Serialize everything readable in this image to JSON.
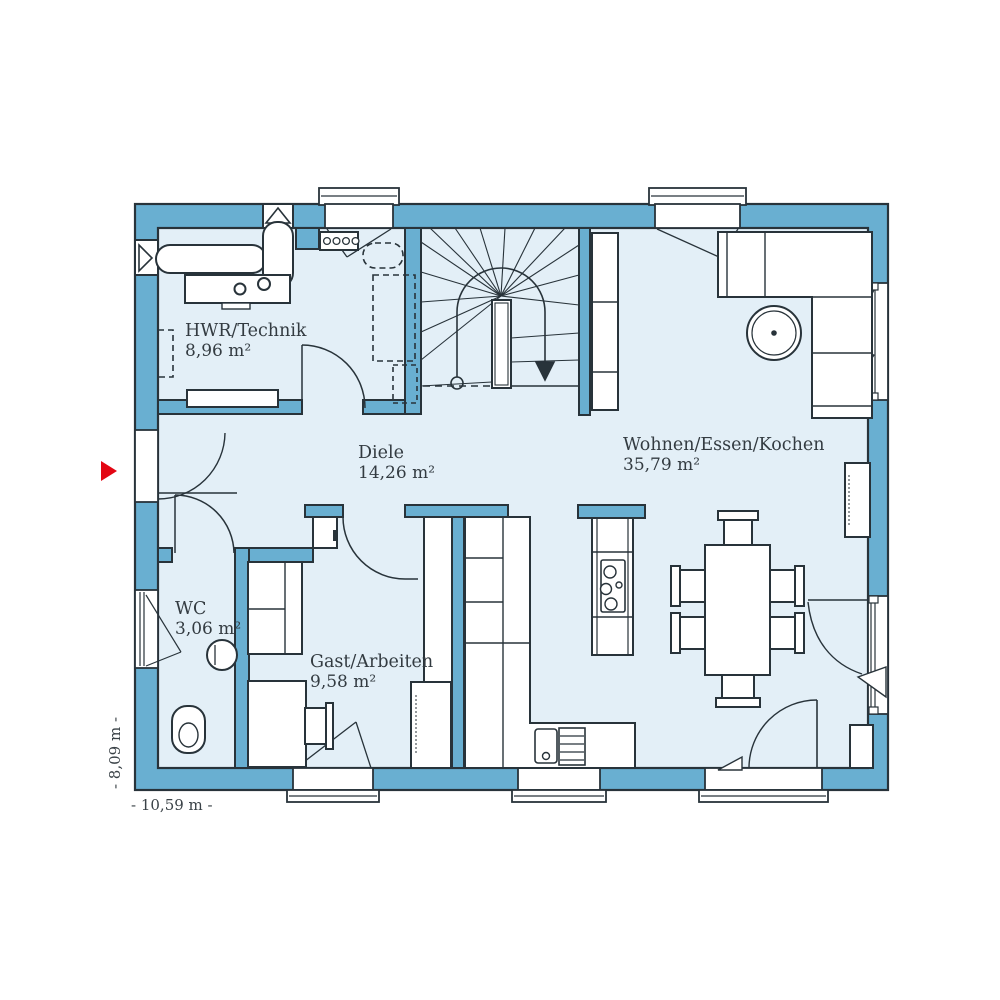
{
  "floor_plan": {
    "type": "house-ground-floor-plan",
    "rooms": [
      {
        "id": "hwr",
        "name": "HWR/Technik",
        "area": "8,96 m²"
      },
      {
        "id": "diele",
        "name": "Diele",
        "area": "14,26 m²"
      },
      {
        "id": "wc",
        "name": "WC",
        "area": "3,06 m²"
      },
      {
        "id": "gast",
        "name": "Gast/Arbeiten",
        "area": "9,58 m²"
      },
      {
        "id": "wohnen",
        "name": "Wohnen/Essen/Kochen",
        "area": "35,79 m²"
      }
    ],
    "dimensions": {
      "width_label": "- 10,59 m -",
      "height_label": "- 8,09 m -"
    },
    "colors": {
      "wall": "#69AFD1",
      "floor": "#E3EFF7",
      "outline": "#28333A",
      "furniture_fill": "#FFFFFF",
      "entrance_arrow": "#E30613",
      "background": "#FFFFFF"
    },
    "fixtures": [
      "winder-staircase",
      "corner-sofa",
      "round-coffee-table",
      "tv-sideboard",
      "dining-table-six-chairs",
      "kitchen-island-cooktop",
      "kitchen-counter-sink-dishwasher",
      "tall-kitchen-cabinets",
      "wardrobe-dashed",
      "coat-rack",
      "laundry-counter",
      "guest-sofa",
      "desk-with-chair",
      "washbasin",
      "toilet",
      "radiator"
    ],
    "markers": {
      "entrance": "red-arrow-left-wall"
    }
  }
}
